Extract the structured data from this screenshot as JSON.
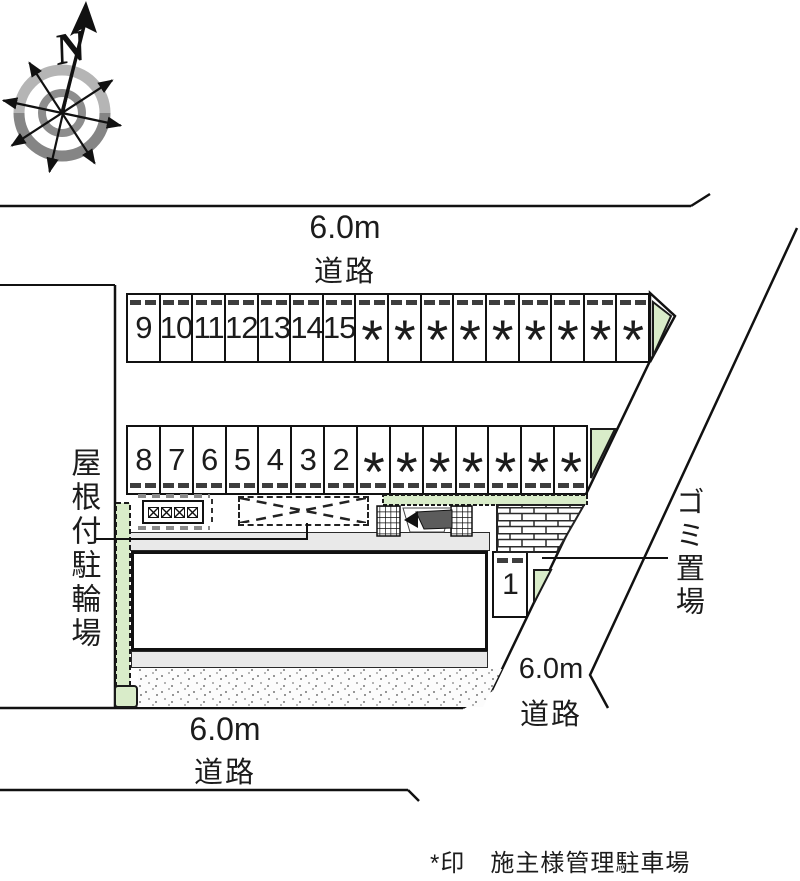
{
  "plan": {
    "compass_label": "N",
    "roads": {
      "top": {
        "width": "6.0m",
        "label": "道路"
      },
      "bottom": {
        "width": "6.0m",
        "label": "道路"
      },
      "right": {
        "width": "6.0m",
        "label": "道路"
      }
    },
    "annotations": {
      "covered_bicycle_parking": "屋根付駐輪場",
      "garbage_area": "ゴミ置場"
    },
    "legend": {
      "note": "*印　施主様管理駐車場"
    },
    "parking": {
      "row_top": {
        "stalls": [
          "9",
          "10",
          "11",
          "12",
          "13",
          "14",
          "15",
          "*",
          "*",
          "*",
          "*",
          "*",
          "*",
          "*",
          "*",
          "*"
        ]
      },
      "row_bottom": {
        "stalls": [
          "8",
          "7",
          "6",
          "5",
          "4",
          "3",
          "2",
          "*",
          "*",
          "*",
          "*",
          "*",
          "*",
          "*"
        ]
      },
      "stall_single": {
        "label": "1"
      }
    },
    "colors": {
      "vegetation": "#d9ecc9",
      "walkway": "#e9e9e9",
      "line": "#111111"
    }
  }
}
